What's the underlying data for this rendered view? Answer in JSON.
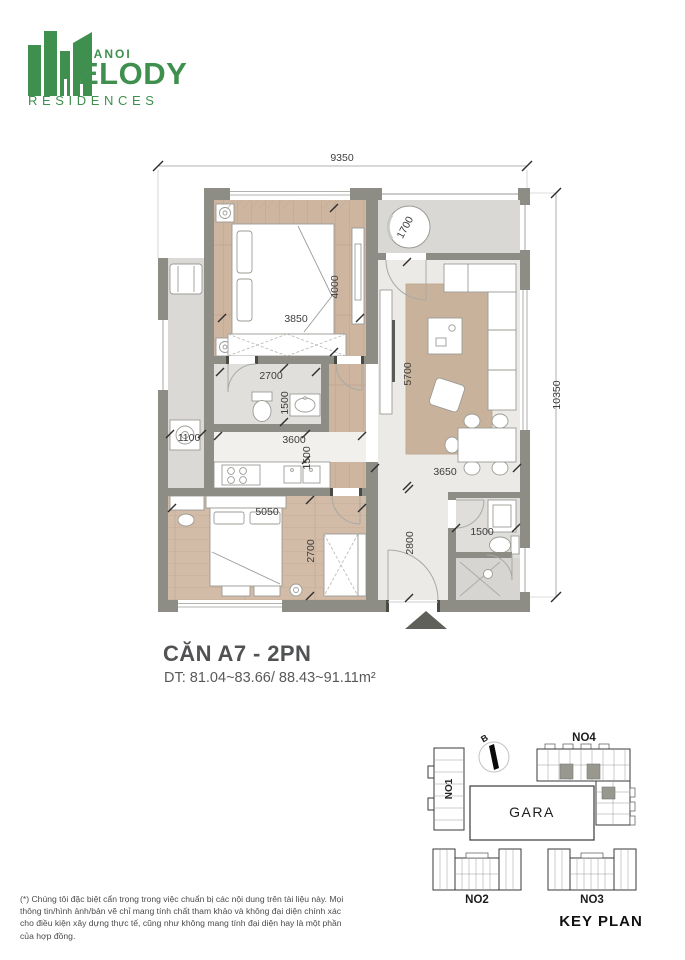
{
  "logo": {
    "hanoi": "HANOI",
    "melody": "ELODY",
    "residences": "RESIDENCES"
  },
  "unit": {
    "title": "CĂN A7 - 2PN",
    "area": "DT: 81.04~83.66/ 88.43~91.11m²"
  },
  "plan": {
    "dims": {
      "overall_w": "9350",
      "overall_h": "10350",
      "balcony": "1700",
      "bed1_w": "3850",
      "bed1_h": "4000",
      "bath1_w": "2700",
      "bath1_h": "1500",
      "living_h": "5700",
      "utility_w": "1100",
      "kitchen_w": "3600",
      "kitchen_h": "1500",
      "dining_w": "3650",
      "bed2_w": "5050",
      "bed2_h": "2700",
      "hall_h": "2800",
      "bath2_w": "1500"
    }
  },
  "keyplan": {
    "title": "KEY PLAN",
    "gara": "GARA",
    "north": "B",
    "no1": "NO1",
    "no2": "NO2",
    "no3": "NO3",
    "no4": "NO4"
  },
  "footnote": {
    "text": "(*) Chúng tôi đặc biệt cẩn trọng trong việc chuẩn bị các nội dung trên tài liệu này. Mọi thông tin/hình ảnh/bản vẽ chỉ mang tính chất tham khảo và không đại diện chính xác cho điều kiện xây dựng thực tế, cũng như không mang tính đại diện hay là một phần của hợp đồng."
  }
}
